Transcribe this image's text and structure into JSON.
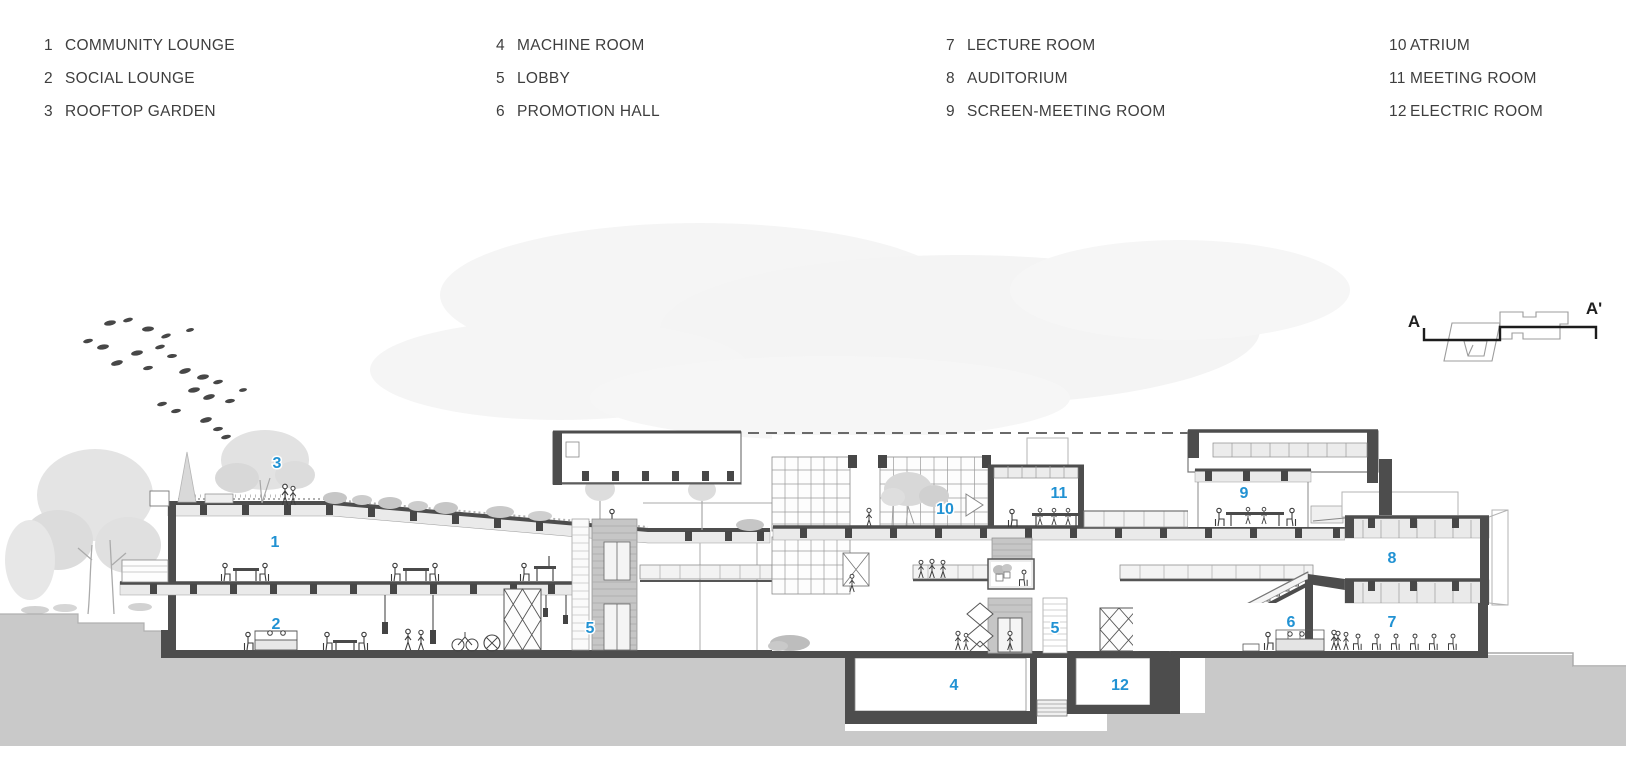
{
  "legend": {
    "columns": [
      {
        "items": [
          {
            "num": "1",
            "label": "COMMUNITY LOUNGE"
          },
          {
            "num": "2",
            "label": "SOCIAL LOUNGE"
          },
          {
            "num": "3",
            "label": "ROOFTOP GARDEN"
          }
        ]
      },
      {
        "items": [
          {
            "num": "4",
            "label": "MACHINE ROOM"
          },
          {
            "num": "5",
            "label": "LOBBY"
          },
          {
            "num": "6",
            "label": "PROMOTION HALL"
          }
        ]
      },
      {
        "items": [
          {
            "num": "7",
            "label": "LECTURE ROOM"
          },
          {
            "num": "8",
            "label": "AUDITORIUM"
          },
          {
            "num": "9",
            "label": "SCREEN-MEETING ROOM"
          }
        ]
      },
      {
        "items": [
          {
            "num": "10",
            "label": "ATRIUM"
          },
          {
            "num": "11",
            "label": "MEETING ROOM"
          },
          {
            "num": "12",
            "label": "ELECTRIC ROOM"
          }
        ]
      }
    ]
  },
  "key_plan": {
    "start_label": "A",
    "end_label": "A'"
  },
  "section": {
    "label_color": "#2192d3",
    "structure_color": "#4d4d4d",
    "earth_color": "#c9c9c9",
    "room_labels": [
      {
        "num": "3",
        "x": 277,
        "y": 468
      },
      {
        "num": "1",
        "x": 275,
        "y": 547
      },
      {
        "num": "2",
        "x": 276,
        "y": 629
      },
      {
        "num": "5",
        "x": 590,
        "y": 633
      },
      {
        "num": "10",
        "x": 945,
        "y": 514
      },
      {
        "num": "11",
        "x": 1059,
        "y": 498
      },
      {
        "num": "9",
        "x": 1244,
        "y": 498
      },
      {
        "num": "8",
        "x": 1392,
        "y": 563
      },
      {
        "num": "6",
        "x": 1291,
        "y": 627
      },
      {
        "num": "7",
        "x": 1392,
        "y": 627
      },
      {
        "num": "5",
        "x": 1055,
        "y": 633
      },
      {
        "num": "4",
        "x": 954,
        "y": 690
      },
      {
        "num": "12",
        "x": 1120,
        "y": 690
      }
    ]
  }
}
